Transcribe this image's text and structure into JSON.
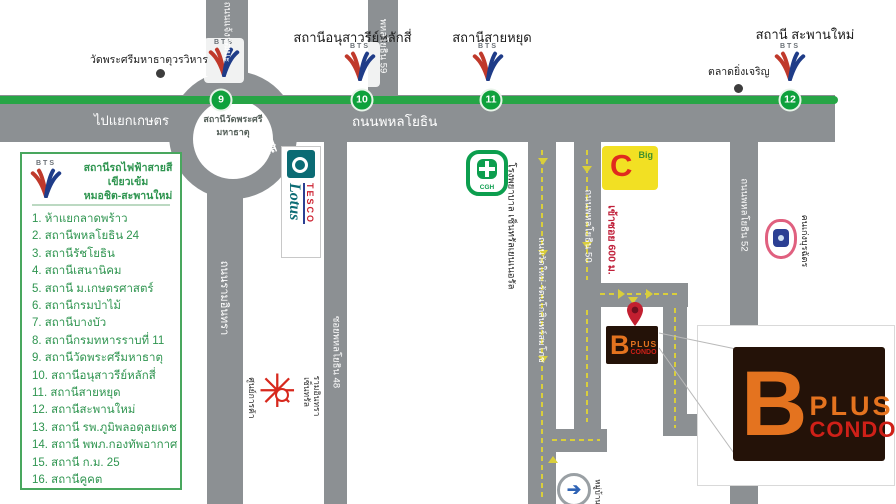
{
  "bts_wordmark": "BTS",
  "legend": {
    "title_line1": "สถานีรถไฟฟ้าสายสีเขียวเข้ม",
    "title_line2": "หมอชิต-สะพานใหม่",
    "items": [
      "1. ห้าแยกลาดพร้าว",
      "2. สถานีพหลโยธิน 24",
      "3. สถานีรัชโยธิน",
      "4. สถานีเสนานิคม",
      "5. สถานี ม.เกษตรศาสตร์",
      "6. สถานีกรมป่าไม้",
      "7. สถานีบางบัว",
      "8. สถานีกรมทหารราบที่ 11",
      "9. สถานีวัดพระศรีมหาธาตุ",
      "10. สถานีอนุสาวรีย์หลักสี่",
      "11. สถานีสายหยุด",
      "12. สถานีสะพานใหม่",
      "13. สถานี รพ.ภูมิพลอดุลยเดช",
      "14. สถานี พพภ.กองทัพอากาศ",
      "15. สถานี ก.ม. 25",
      "16. สถานีคูคต"
    ]
  },
  "line_badges": {
    "b9": "9",
    "b10": "10",
    "b11": "11",
    "b12": "12"
  },
  "stations": {
    "s10": "สถานีอนุสาวรีย์หลักสี่",
    "s11": "สถานีสายหยุด",
    "s12": "สถานี สะพานใหม่"
  },
  "roundabout": {
    "name": "วงเวียนหลักสี่",
    "inner_line1": "สถานีวัดพระศรี",
    "inner_line2": "มหาธาตุ"
  },
  "roads": {
    "phahonyothin": "ถนนพหลโยธิน",
    "to_kaset": "ไปแยกเกษตร",
    "chaengwatthana": "ถนนแจ้งวัฒนะ",
    "soi59": "พหลโยธิน 59",
    "ramintra": "ถนนรามอินทรา",
    "soi48": "ซอยพหลโยธิน 48",
    "watmai": "ถนนวัดใหม่-รัตนโกสินทร์สมโภช",
    "soi50": "ถนนพหลโยธิน 50",
    "soi52": "ถนนพหลโยธิน 52"
  },
  "places": {
    "temple": "วัดพระศรีมหาธาตุวรวิหาร",
    "market": "ตลาดยิ่งเจริญ",
    "hospital": "โรงพยาบาล เซ็นทรัลเยนเนอรัล",
    "hospital_logo": "CGH",
    "bigc_letter": "C",
    "bigc_small": "Big",
    "soi_note": "เข้าซอย 600 ม.",
    "tesco": "TESCO",
    "lotus": "Lotus",
    "mall_left": "ศูนย์การค้า",
    "mall_line1": "เซ็นทรัล",
    "mall_line2": "รามอินทรา",
    "school": "คนเก่งบุรฉัตร",
    "village": "หมู่บ้าน"
  },
  "condo": {
    "b": "B",
    "plus": "PLUS",
    "condo": "CONDO"
  },
  "colors": {
    "bts_green": "#27a546",
    "road_gray": "#8c9093",
    "route_yellow": "#d9ce3b",
    "condo_orange": "#e4731f",
    "condo_red": "#cf2018",
    "legend_green": "#2f9550"
  }
}
